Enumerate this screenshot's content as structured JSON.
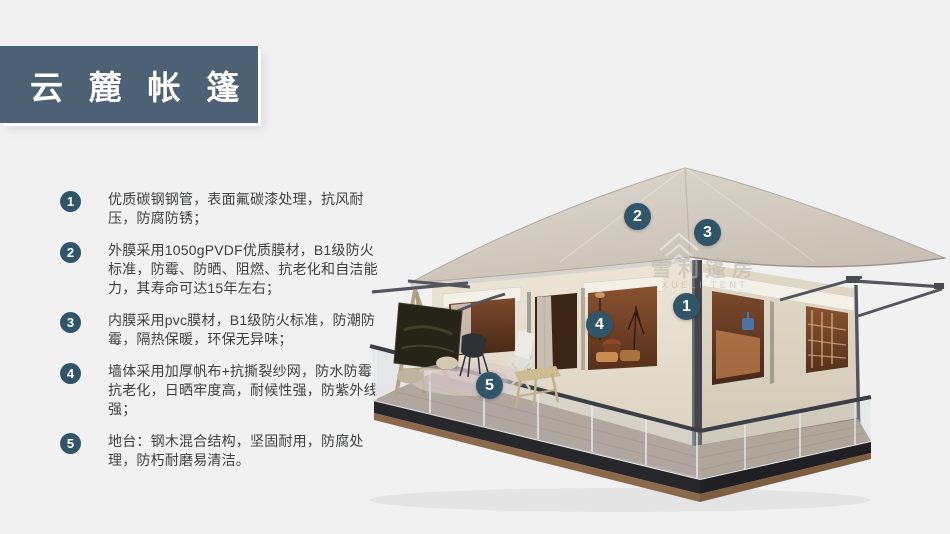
{
  "title": "云麓帐篷",
  "features": [
    {
      "num": "1",
      "text": "优质碳钢钢管，表面氟碳漆处理，抗风耐压，防腐防锈；"
    },
    {
      "num": "2",
      "text": "外膜采用1050gPVDF优质膜材，B1级防火标准，防霉、防晒、阻燃、抗老化和自洁能力，其寿命可达15年左右；"
    },
    {
      "num": "3",
      "text": "内膜采用pvc膜材，B1级防火标准，防潮防霉，隔热保暖，环保无异味；"
    },
    {
      "num": "4",
      "text": "墙体采用加厚帆布+抗撕裂纱网，防水防霉抗老化，日晒牢度高，耐候性强，防紫外线强；"
    },
    {
      "num": "5",
      "text": "地台：钢木混合结构，坚固耐用，防腐处理，防朽耐磨易清洁。"
    }
  ],
  "callouts": [
    {
      "num": "1"
    },
    {
      "num": "2"
    },
    {
      "num": "3"
    },
    {
      "num": "4"
    },
    {
      "num": "5"
    }
  ],
  "watermark": {
    "cn": "雪利篷房",
    "en": "XUELI TENT"
  },
  "colors": {
    "banner": "#4c6173",
    "badge": "#305569",
    "background": "#f1f1f2",
    "text": "#3f4042",
    "roof": "#d5cec5",
    "wall": "#e9e2d3",
    "window": "#6b4026",
    "deck": "#a89a8c"
  }
}
